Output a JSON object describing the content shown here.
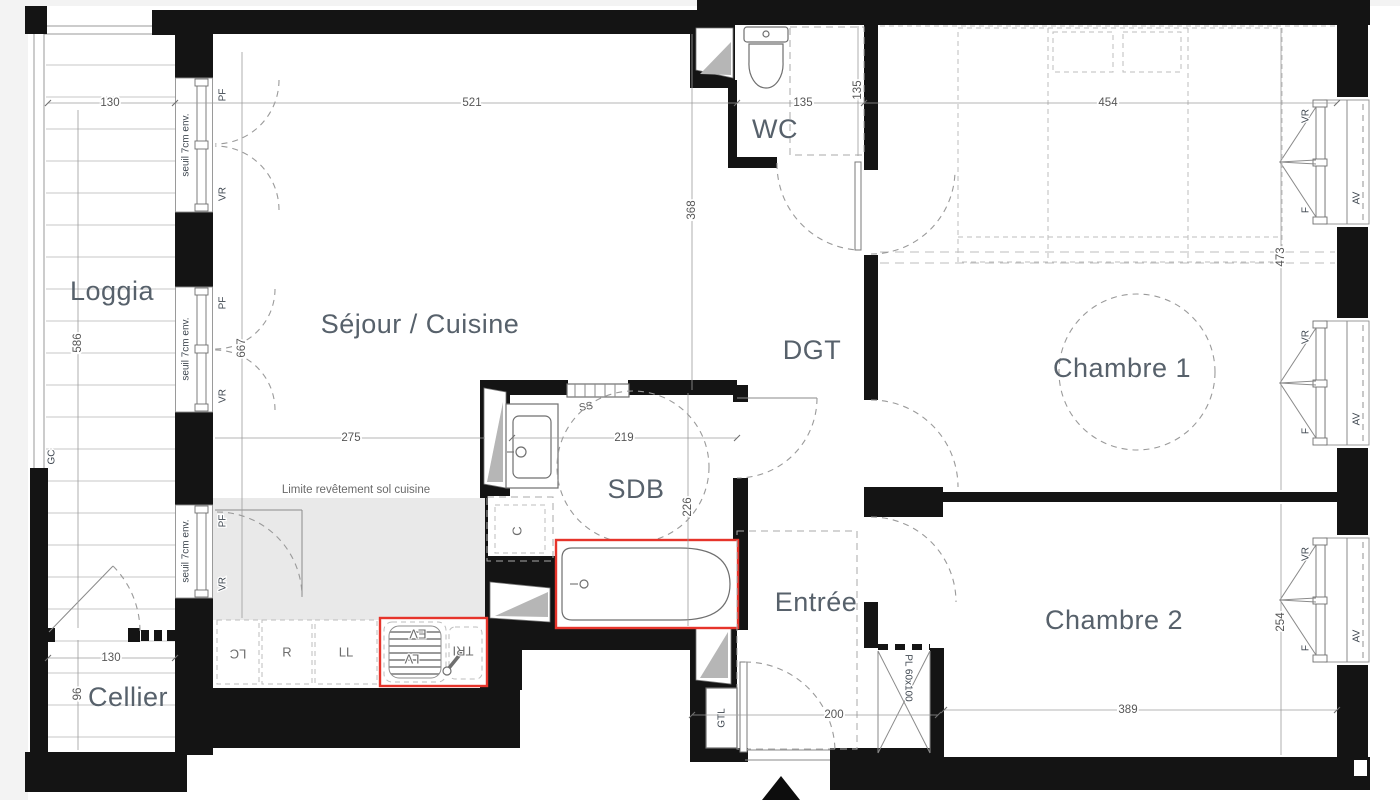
{
  "plan": {
    "rooms": {
      "loggia": "Loggia",
      "cellier": "Cellier",
      "sejour": "Séjour / Cuisine",
      "wc": "WC",
      "dgt": "DGT",
      "sdb": "SDB",
      "entree": "Entrée",
      "chambre1": "Chambre 1",
      "chambre2": "Chambre 2"
    },
    "dims": {
      "loggia_width": "130",
      "loggia_height": "586",
      "cellier_width": "130",
      "cellier_height": "96",
      "sejour_width": "521",
      "sejour_height": "368",
      "facade_height": "667",
      "kitchen_width": "275",
      "wc_width": "135",
      "wc_depth": "135",
      "sdb_width": "219",
      "sdb_depth": "226",
      "entree_width": "200",
      "chambre1_width": "454",
      "chambre1_depth": "473",
      "chambre2_width": "389",
      "chambre2_depth": "254"
    },
    "ann": {
      "seuil": "seuil 7cm env.",
      "limite": "Limite revêtement sol cuisine",
      "gc": "GC",
      "gtl": "GTL",
      "ss": "SS",
      "c": "C",
      "pl": "PL 60x100",
      "pf": "PF",
      "vr": "VR",
      "f": "F",
      "av": "AV",
      "lc": "LC",
      "r": "R",
      "ll": "LL",
      "ev": "EV",
      "lv": "LV",
      "tri": "TRI"
    },
    "colors": {
      "wall": "#141414",
      "accent_red": "#e6342b",
      "room_label": "#57616b",
      "dim_text": "#565656",
      "kitchen_floor": "#e9e9e9",
      "shaft_gray": "#b6b6b6"
    }
  }
}
